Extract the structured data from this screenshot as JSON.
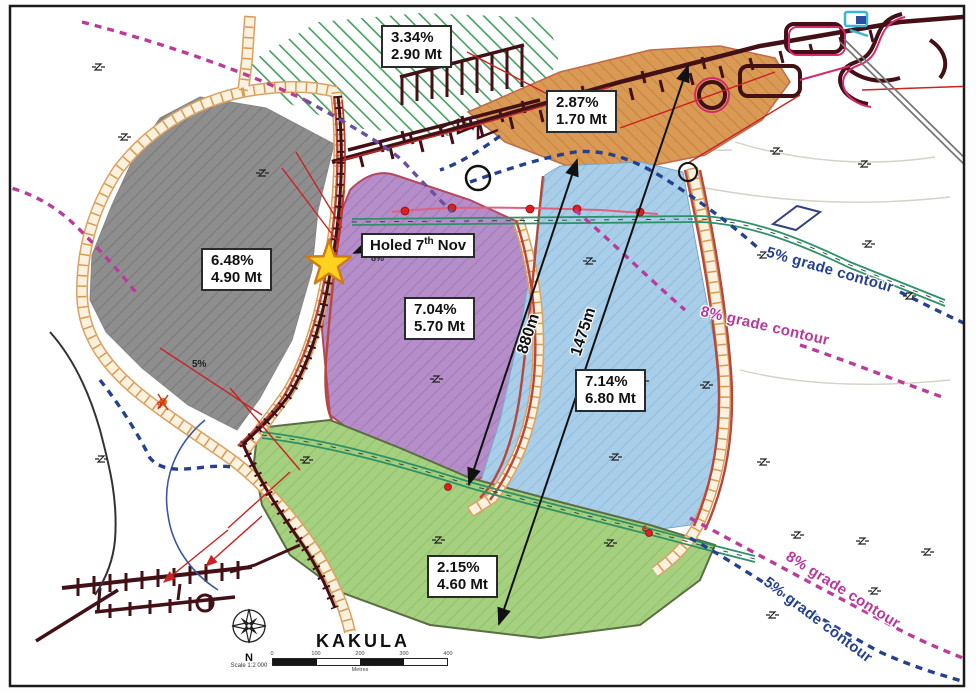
{
  "map_title": "KAKULA",
  "compass": {
    "north_label": "N",
    "scale_note": "Scale 1:2 000"
  },
  "scale_bar": {
    "ticks": [
      "0",
      "100",
      "200",
      "300",
      "400"
    ],
    "unit_label": "Metres"
  },
  "zone_labels": {
    "north": {
      "grade": "3.34%",
      "tonnage": "2.90 Mt"
    },
    "orange": {
      "grade": "2.87%",
      "tonnage": "1.70 Mt"
    },
    "gray": {
      "grade": "6.48%",
      "tonnage": "4.90 Mt"
    },
    "purple": {
      "grade": "7.04%",
      "tonnage": "5.70 Mt"
    },
    "blue": {
      "grade": "7.14%",
      "tonnage": "6.80 Mt"
    },
    "green": {
      "grade": "2.15%",
      "tonnage": "4.60 Mt"
    }
  },
  "callouts": {
    "holed": {
      "text_main": "Holed 7",
      "superscript": "th",
      "text_tail": " Nov"
    }
  },
  "measurements": {
    "west_span": "880m",
    "east_span": "1475m"
  },
  "contour_labels": {
    "upper_5": "5% grade contour",
    "upper_8": "8% grade contour",
    "lower_8": "8% grade contour",
    "lower_5": "5% grade contour"
  },
  "small_markers": {
    "grade_5": "5%",
    "grade_8": "8%",
    "decline_9": "9",
    "decline_6": "6"
  },
  "colors": {
    "gray_zone": "#8e8e8e",
    "purple_zone": "#b58ec9",
    "blue_zone": "#a8cee9",
    "green_zone": "#a5d07f",
    "orange_zone": "#d99a55",
    "contour_5": "#24408f",
    "contour_8": "#bb3b9b",
    "ramp": "#dd9f58",
    "tunnel": "#431016",
    "star": "#ffd21f"
  }
}
